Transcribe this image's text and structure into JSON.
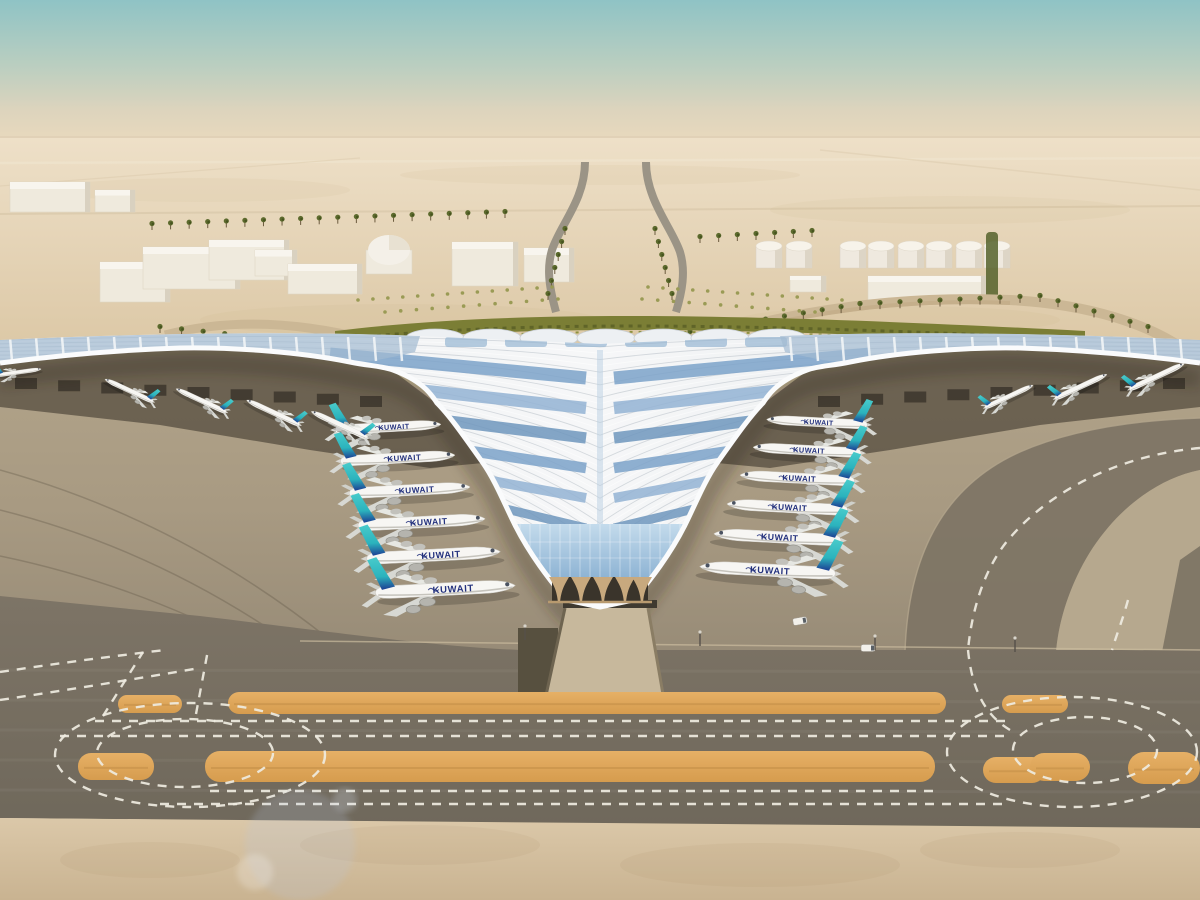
{
  "meta": {
    "description": "Aerial rendering of Kuwait International Airport trefoil terminal: swooping silver canopy with blue solar panels, Kuwait Airways fleet parked at gates, desert campus with warehouses, dome building and fuel tanks, palm-lined approach roads, foreground taxiways with orange painted strips and white dashed guide lines"
  },
  "airline": {
    "label": "KUWAIT"
  },
  "palette": {
    "sky_top": "#8fc3c5",
    "sky_mid": "#b9cec0",
    "sky_horizon": "#e8d8bd",
    "desert_light": "#eee0c8",
    "desert_deep": "#dcc8a6",
    "building_white": "#efeadd",
    "building_top": "#f8f5ee",
    "building_shadow": "#d9d1c0",
    "palm_green": "#5c6a2d",
    "hedge_green": "#7b7e35",
    "shrub_green": "#9a9b55",
    "roof_light": "#f5f6f8",
    "roof_mid": "#e9ecef",
    "solar_blue": "#7ba2c9",
    "glass_blue": "#a9c6de",
    "facade_tan": "#ac9371",
    "column_tan": "#c8a97e",
    "apron_light": "#b2a48a",
    "apron_dark": "#968a76",
    "taxi_dark": "#7b7263",
    "paint_orange": "#e0a85c",
    "marking_white": "#efece1",
    "tail_teal": "#3bbfc4",
    "tail_navy": "#1d3f93",
    "fuselage_white": "#f7f6f3",
    "title_navy": "#23317d",
    "sand_bottom": "#d9c6a7"
  },
  "planes": {
    "inner_left": {
      "dir": 1,
      "rot": -3,
      "label": true,
      "list": [
        [
          390,
          427,
          1.0
        ],
        [
          400,
          458,
          1.08
        ],
        [
          412,
          490,
          1.14
        ],
        [
          424,
          522,
          1.2
        ],
        [
          436,
          555,
          1.26
        ],
        [
          448,
          589,
          1.32
        ]
      ]
    },
    "inner_right": {
      "dir": -1,
      "rot": 3,
      "label": true,
      "list": [
        [
          815,
          422,
          0.95
        ],
        [
          805,
          450,
          1.02
        ],
        [
          795,
          478,
          1.08
        ],
        [
          785,
          507,
          1.14
        ],
        [
          775,
          537,
          1.2
        ],
        [
          765,
          570,
          1.28
        ]
      ]
    },
    "outer_left": {
      "dir": -1,
      "rot": 25,
      "label": false,
      "list": [
        [
          128,
          390,
          0.5
        ],
        [
          200,
          400,
          0.52
        ],
        [
          272,
          412,
          0.55
        ],
        [
          338,
          424,
          0.58
        ]
      ]
    },
    "outer_right": {
      "dir": 1,
      "rot": -25,
      "label": false,
      "list": [
        [
          1010,
          396,
          0.5
        ],
        [
          1082,
          386,
          0.54
        ],
        [
          1158,
          376,
          0.57
        ]
      ]
    },
    "remote": {
      "dir": 1,
      "rot": -8,
      "label": false,
      "list": [
        [
          20,
          372,
          0.42
        ]
      ]
    }
  },
  "palm_rows": [
    [
      152,
      230,
      505,
      218,
      20
    ],
    [
      160,
      333,
      462,
      366,
      15
    ],
    [
      690,
      338,
      860,
      310,
      10
    ],
    [
      860,
      310,
      1040,
      302,
      10
    ],
    [
      1040,
      302,
      1148,
      333,
      7
    ],
    [
      700,
      243,
      812,
      237,
      7
    ],
    [
      565,
      235,
      548,
      300,
      6
    ],
    [
      655,
      235,
      672,
      300,
      6
    ]
  ],
  "shrub_rows": [
    [
      358,
      300,
      552,
      287,
      14
    ],
    [
      648,
      287,
      842,
      300,
      14
    ],
    [
      385,
      312,
      558,
      299,
      12
    ],
    [
      642,
      299,
      815,
      312,
      12
    ]
  ],
  "tanks": {
    "y": 246,
    "w": 26,
    "h": 22,
    "xs": [
      756,
      786,
      840,
      868,
      898,
      926,
      956,
      984
    ]
  },
  "warehouses": [
    [
      100,
      262,
      70,
      40
    ],
    [
      143,
      247,
      97,
      42
    ],
    [
      209,
      240,
      80,
      40
    ],
    [
      255,
      250,
      42,
      26
    ],
    [
      288,
      264,
      74,
      30
    ],
    [
      452,
      242,
      66,
      44
    ],
    [
      524,
      248,
      50,
      34
    ],
    [
      868,
      276,
      118,
      24
    ],
    [
      790,
      276,
      36,
      16
    ],
    [
      10,
      182,
      80,
      30
    ],
    [
      95,
      190,
      40,
      22
    ]
  ],
  "orange_strips": [
    [
      228,
      692,
      718,
      22,
      11
    ],
    [
      1002,
      695,
      66,
      18,
      9
    ],
    [
      118,
      695,
      64,
      18,
      9
    ],
    [
      205,
      751,
      730,
      31,
      15
    ],
    [
      78,
      753,
      76,
      27,
      13
    ],
    [
      983,
      757,
      62,
      26,
      13
    ],
    [
      1030,
      753,
      60,
      28,
      14
    ],
    [
      1128,
      752,
      72,
      32,
      16
    ]
  ],
  "dash_h": [
    [
      95,
      721,
      1008
    ],
    [
      60,
      736,
      1008
    ],
    [
      210,
      791,
      938
    ],
    [
      160,
      804,
      1002
    ]
  ],
  "dash_d": [
    [
      103,
      716,
      143,
      652
    ],
    [
      196,
      714,
      208,
      650
    ]
  ],
  "dash_e": [
    [
      190,
      755,
      135,
      52
    ],
    [
      185,
      753,
      88,
      34
    ],
    [
      1072,
      752,
      125,
      55
    ],
    [
      1085,
      750,
      72,
      33
    ]
  ],
  "dash_p": [
    "M1200,448 C1120,455 1050,490 1008,540 C985,568 972,608 968,650",
    "M968,650 C972,690 985,715 1010,730",
    "M1128,600 C1122,622 1116,636 1112,650",
    "M0,700 Q100,685 200,668",
    "M0,672 Q80,660 165,650"
  ],
  "apron_arcs": [
    "M0,470 Q180,520 330,640",
    "M0,510 Q160,550 300,650",
    "M0,556 Q140,585 268,655",
    "M0,600 Q120,620 240,658"
  ],
  "ribs": {
    "count": 40
  },
  "chevrons": {
    "count": 8,
    "colors": [
      "#7ba2c9",
      "#93b3d3",
      "#6e96bd"
    ]
  },
  "scallops": {
    "cy": 338,
    "rx": 29,
    "ry": 9,
    "xs": [
      435,
      492,
      549,
      606,
      663,
      720,
      777
    ]
  },
  "upper_panels": {
    "y": 337,
    "w": 42,
    "h": 10,
    "xs": [
      445,
      505,
      565,
      625,
      685,
      745
    ]
  },
  "poles": [
    [
      525,
      640
    ],
    [
      700,
      646
    ],
    [
      875,
      650
    ],
    [
      1015,
      652
    ]
  ],
  "vans": [
    [
      800,
      621,
      -10
    ],
    [
      868,
      648,
      0
    ]
  ],
  "flares": [
    [
      300,
      845,
      55,
      "rgba(185,200,225,0.20)"
    ],
    [
      255,
      872,
      18,
      "rgba(255,255,255,0.22)"
    ],
    [
      345,
      800,
      12,
      "rgba(215,228,245,0.25)"
    ]
  ]
}
